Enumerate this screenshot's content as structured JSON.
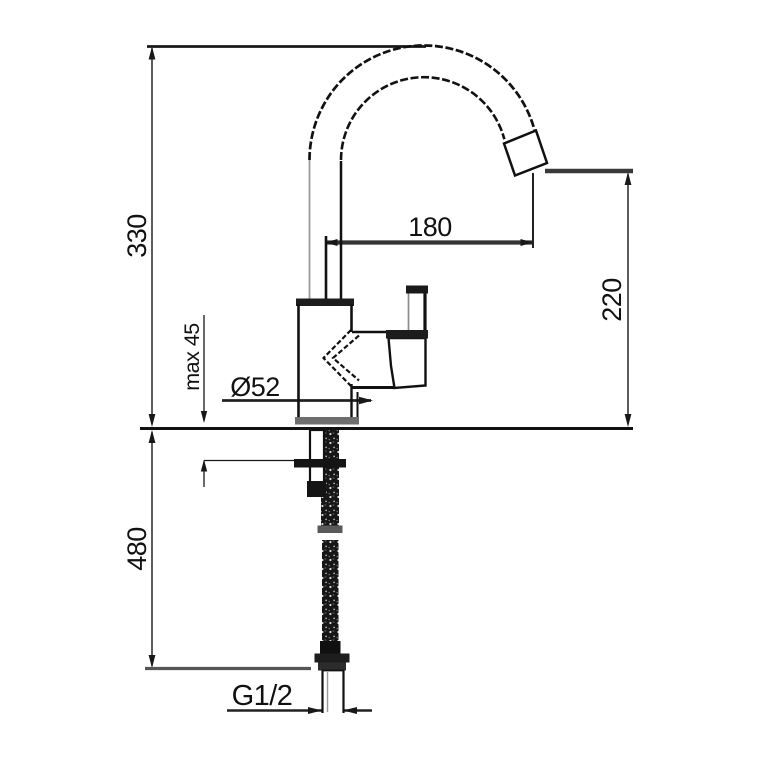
{
  "drawing": {
    "subject": "single-lever-kitchen-mixer-tap-installation-diagram",
    "units": "mm",
    "background_color": "#ffffff",
    "line_color": "#1a1a1a",
    "labels": {
      "height_overall": "330",
      "spout_reach": "180",
      "outlet_height": "220",
      "max_mounting_thickness": "max 45",
      "base_diameter": "Ø52",
      "hose_length": "480",
      "connection_thread": "G1/2"
    }
  }
}
